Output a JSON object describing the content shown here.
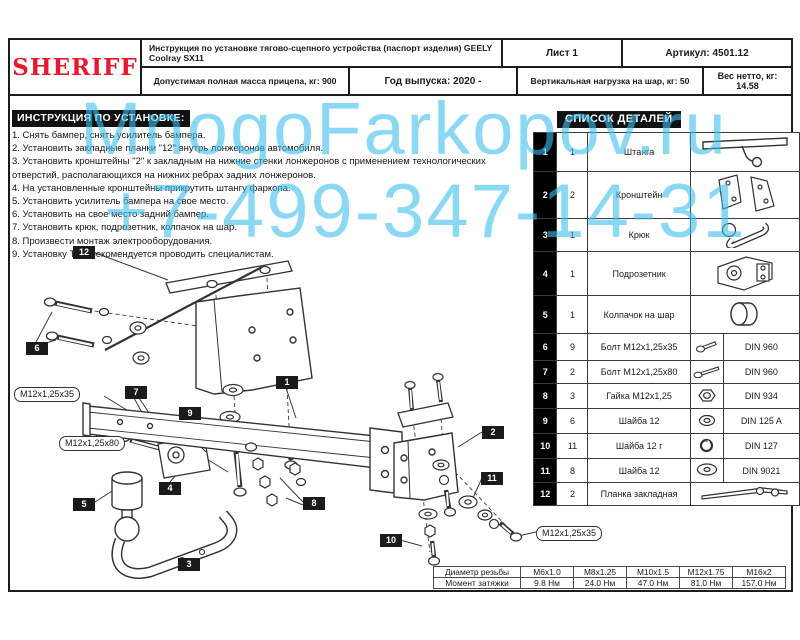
{
  "header": {
    "logo": "SHERIFF",
    "title": "Инструкция по установке тягово-сцепного устройства (паспорт изделия) GEELY Coolray SX11",
    "sheet": "Лист 1",
    "article": "Артикул: 4501.12",
    "mass": "Допустимая полная масса прицепа, кг: 900",
    "year": "Год выпуска: 2020 -",
    "vertical_load": "Вертикальная нагрузка на шар, кг: 50",
    "net_weight": "Вес нетто, кг: 14.58"
  },
  "instructions": {
    "title": "ИНСТРУКЦИЯ ПО УСТАНОВКЕ:",
    "items": [
      "1. Снять бампер, снять усилитель бампера.",
      "2. Установить закладные планки \"12\" внутрь лонжеронов автомобиля.",
      "3. Установить кронштейны \"2\" к закладным на нижние стенки лонжеронов с применением технологических отверстий, располагающихся на нижних ребрах задних лонжеронов.",
      "4. На установленные кронштейны прикрутить штангу фаркопа.",
      "5. Установить усилитель бампера на свое место.",
      "6. Установить на свое место задний бампер.",
      "7. Установить крюк, подрозетник, колпачок на шар.",
      "8. Произвести монтаж электрооборудования.",
      "9. Установку ТСУ рекомендуется проводить специалистам."
    ]
  },
  "parts": {
    "title": "СПИСОК ДЕТАЛЕЙ",
    "rows": [
      {
        "num": "1",
        "qty": "1",
        "name": "Штанга",
        "din": "",
        "icon": "towbar-icon"
      },
      {
        "num": "2",
        "qty": "2",
        "name": "Кронштейн",
        "din": "",
        "icon": "bracket-pair-icon"
      },
      {
        "num": "3",
        "qty": "1",
        "name": "Крюк",
        "din": "",
        "icon": "hook-icon"
      },
      {
        "num": "4",
        "qty": "1",
        "name": "Подрозетник",
        "din": "",
        "icon": "socket-plate-icon"
      },
      {
        "num": "5",
        "qty": "1",
        "name": "Колпачок на шар",
        "din": "",
        "icon": "ball-cap-icon"
      },
      {
        "num": "6",
        "qty": "9",
        "name": "Болт М12х1,25х35",
        "din": "DIN 960",
        "icon": "bolt-icon"
      },
      {
        "num": "7",
        "qty": "2",
        "name": "Болт М12х1,25х80",
        "din": "DIN 960",
        "icon": "bolt-long-icon"
      },
      {
        "num": "8",
        "qty": "3",
        "name": "Гайка М12х1,25",
        "din": "DIN 934",
        "icon": "nut-icon"
      },
      {
        "num": "9",
        "qty": "6",
        "name": "Шайба 12",
        "din": "DIN 125 A",
        "icon": "washer-icon"
      },
      {
        "num": "10",
        "qty": "11",
        "name": "Шайба 12 г",
        "din": "DIN 127",
        "icon": "spring-washer-icon"
      },
      {
        "num": "11",
        "qty": "8",
        "name": "Шайба 12",
        "din": "DIN 9021",
        "icon": "flat-washer-icon"
      },
      {
        "num": "12",
        "qty": "2",
        "name": "Планка закладная",
        "din": "",
        "icon": "embed-plate-icon"
      }
    ]
  },
  "diagram": {
    "labels": [
      {
        "text": "12",
        "x": 73,
        "y": 246
      },
      {
        "text": "6",
        "x": 26,
        "y": 342
      },
      {
        "text": "7",
        "x": 125,
        "y": 386
      },
      {
        "text": "9",
        "x": 179,
        "y": 407
      },
      {
        "text": "1",
        "x": 276,
        "y": 376
      },
      {
        "text": "4",
        "x": 159,
        "y": 482
      },
      {
        "text": "5",
        "x": 73,
        "y": 498
      },
      {
        "text": "3",
        "x": 178,
        "y": 558
      },
      {
        "text": "8",
        "x": 303,
        "y": 497
      },
      {
        "text": "2",
        "x": 482,
        "y": 426
      },
      {
        "text": "11",
        "x": 481,
        "y": 472
      },
      {
        "text": "10",
        "x": 380,
        "y": 534
      }
    ],
    "callouts": [
      {
        "text": "М12х1,25х35",
        "x": 14,
        "y": 387
      },
      {
        "text": "М12х1,25х80",
        "x": 59,
        "y": 436
      },
      {
        "text": "М12х1,25х35",
        "x": 536,
        "y": 526
      }
    ]
  },
  "torque": {
    "diameter_label": "Диаметр резьбы",
    "moment_label": "Момент затяжки",
    "columns": [
      "М6х1.0",
      "М8х1.25",
      "М10х1.5",
      "М12х1.75",
      "М16х2"
    ],
    "values": [
      "9.8 Нм",
      "24.0 Нм",
      "47.0 Нм",
      "81.0 Нм",
      "157.0 Нм"
    ]
  },
  "watermark": {
    "line1": "MnogoFarkopov.ru",
    "line2": "+7-499-347-14-31",
    "color": "#3fbfed"
  },
  "colors": {
    "brand_red": "#e8182f",
    "ink": "#1a1a1a"
  }
}
